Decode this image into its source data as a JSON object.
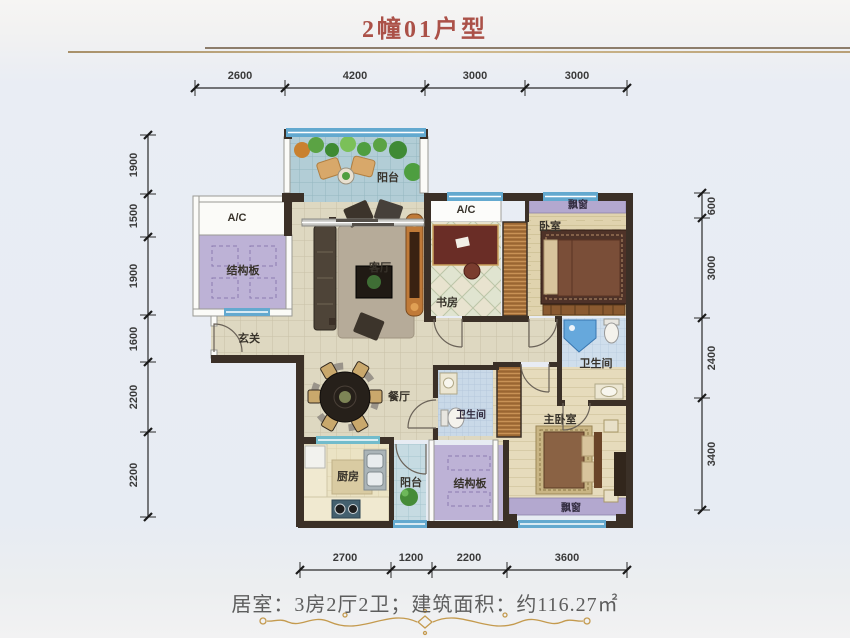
{
  "title": "2幢01户型",
  "footer": {
    "summary": "居室：3房2厅2卫；建筑面积：约116.27㎡"
  },
  "rooms": {
    "balcony_top": "阳台",
    "ac_left": "A/C",
    "ac_right": "A/C",
    "slab_left": "结构板",
    "slab_bottom": "结构板",
    "living": "客厅",
    "dining": "餐厅",
    "study": "书房",
    "bedroom": "卧室",
    "master_bedroom": "主卧室",
    "bath_main": "卫生间",
    "bath_second": "卫生间",
    "kitchen": "厨房",
    "balcony_bottom": "阳台",
    "foyer": "玄关",
    "bay_window_top": "飘窗",
    "bay_window_bottom": "飘窗"
  },
  "dimensions": {
    "top": [
      "2600",
      "4200",
      "3000",
      "3000"
    ],
    "bottom": [
      "2700",
      "1200",
      "2200",
      "3600"
    ],
    "left": [
      "1900",
      "1500",
      "1900",
      "1600",
      "2200",
      "2200"
    ],
    "right": [
      "600",
      "3000",
      "2400",
      "3400"
    ]
  },
  "colors": {
    "title_red": "#ab5148",
    "gold": "#c49a4e",
    "wall_dark": "#3b3027",
    "window_blue": "#63a9cf",
    "slab_purple": "#bdb2d6",
    "bay_purple": "#b3a8cf"
  }
}
